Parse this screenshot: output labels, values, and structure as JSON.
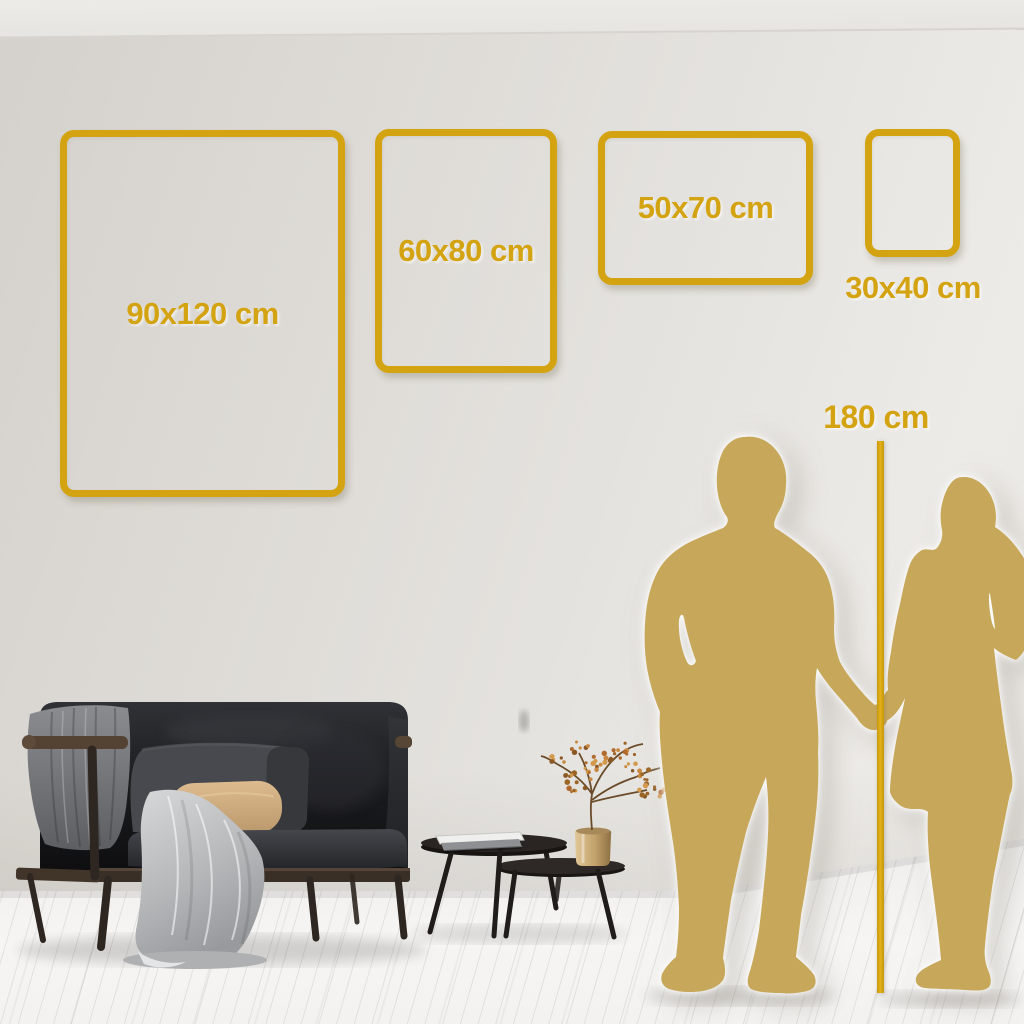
{
  "size_guide": {
    "frames": [
      {
        "id": "90x120",
        "label": "90x120 cm",
        "width_cm": 90,
        "height_cm": 120,
        "orientation": "portrait",
        "label_position": "inside"
      },
      {
        "id": "60x80",
        "label": "60x80 cm",
        "width_cm": 60,
        "height_cm": 80,
        "orientation": "portrait",
        "label_position": "inside"
      },
      {
        "id": "50x70",
        "label": "50x70 cm",
        "width_cm": 50,
        "height_cm": 70,
        "orientation": "landscape",
        "label_position": "inside"
      },
      {
        "id": "30x40",
        "label": "30x40 cm",
        "width_cm": 30,
        "height_cm": 40,
        "orientation": "portrait",
        "label_position": "below"
      }
    ],
    "height_reference": {
      "label": "180 cm",
      "height_cm": 180
    }
  },
  "colors": {
    "accent_gold": "#D4A312",
    "silhouette_gold": "#C7A85A",
    "wall": "#E2DFDA",
    "floor": "#F4F3F1"
  },
  "scene_objects": [
    "sofa",
    "throw-blanket",
    "cushions",
    "nesting-coffee-tables",
    "books",
    "brass-vase",
    "dried-branch",
    "man-silhouette",
    "woman-silhouette",
    "height-reference-line"
  ]
}
